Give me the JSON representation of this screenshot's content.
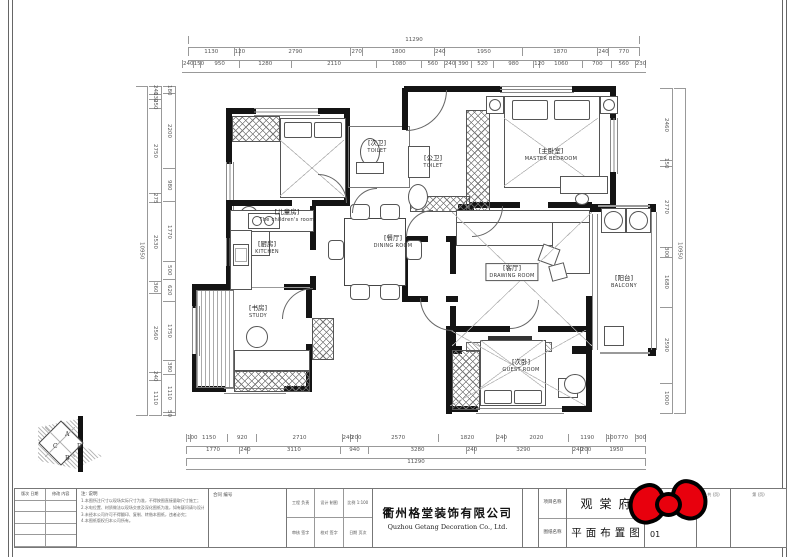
{
  "rooms": [
    {
      "id": "children",
      "cn": "[儿童房]",
      "en": "The children's room"
    },
    {
      "id": "toilet_small",
      "cn": "[次卫]",
      "en": "TOILET"
    },
    {
      "id": "toilet_main",
      "cn": "[公卫]",
      "en": "TOILET"
    },
    {
      "id": "master",
      "cn": "[主卧室]",
      "en": "MASTER BEDROOM"
    },
    {
      "id": "kitchen",
      "cn": "[厨房]",
      "en": "KITCHEN"
    },
    {
      "id": "dining",
      "cn": "[餐厅]",
      "en": "DINING ROOM"
    },
    {
      "id": "living",
      "cn": "[客厅]",
      "en": "DRAWING ROOM"
    },
    {
      "id": "balcony",
      "cn": "[阳台]",
      "en": "BALCONY"
    },
    {
      "id": "study",
      "cn": "[书房]",
      "en": "STUDY"
    },
    {
      "id": "guest",
      "cn": "[次卧]",
      "en": "GUEST ROOM"
    }
  ],
  "dimensions": {
    "top_total": "11290",
    "top_row2": [
      "1130",
      "120",
      "2790",
      "270",
      "1800",
      "240",
      "1950",
      "1870",
      "240",
      "770"
    ],
    "top_row3": [
      "240",
      "150",
      "950",
      "1280",
      "2110",
      "1080",
      "560",
      "240",
      "390",
      "520",
      "980",
      "120",
      "1060",
      "700",
      "560",
      "230"
    ],
    "bottom_row1": [
      "100",
      "1150",
      "920",
      "2710",
      "240",
      "200",
      "2570",
      "1820",
      "240",
      "2020",
      "1190",
      "100",
      "770",
      "300"
    ],
    "bottom_row2": [
      "1770",
      "240",
      "3110",
      "940",
      "3280",
      "240",
      "3290",
      "240",
      "200",
      "1950"
    ],
    "bottom_total": "11290",
    "left_total": "10950",
    "left_col1": [
      "240",
      "130",
      "250",
      "2750",
      "275",
      "2530",
      "360",
      "2560",
      "240",
      "1110"
    ],
    "left_col2": [
      "180",
      "2200",
      "980",
      "1770",
      "500",
      "620",
      "1750",
      "380",
      "1110",
      "50"
    ],
    "right_col": [
      "2460",
      "150",
      "2770",
      "300",
      "1680",
      "2590",
      "1000"
    ],
    "right_total": "10950"
  },
  "north_symbol": {
    "letters": [
      "A",
      "D",
      "B",
      "C"
    ]
  },
  "title_block": {
    "bow_color": "#e8000d",
    "revision_headers": [
      "版次 日期",
      "修改 内容"
    ],
    "notes_label": "注: 说明",
    "notes_lines": [
      "1.本图所注尺寸以现场实际尺寸为准，不得按图直接量取尺寸施工；",
      "2.水电位置、材质做法以现场交底及深化图纸为准，如有疑问请与设计师联系；",
      "3.未经本公司许可不得翻印、复制、转借本图纸，违者必究；",
      "4.本图纸版权归本公司所有。"
    ],
    "contract_label": "合同 编号",
    "info_cells": [
      "工程 负责",
      "设计 制图",
      "比例 1:100",
      "审核 签字",
      "校对 签字",
      "日期 页次"
    ],
    "company_cn": "衢州格堂装饰有限公司",
    "company_en": "Quzhou Getang Decoration Co., Ltd.",
    "field_labels": [
      "项目名称",
      "图纸名称"
    ],
    "project_name": "观棠府",
    "drawing_name": "平面布置图",
    "sheet_cols": [
      {
        "header": "图号 (张次)",
        "value": "01"
      },
      {
        "header": "共 (页)",
        "value": ""
      },
      {
        "header": "第 (页)",
        "value": ""
      }
    ]
  }
}
